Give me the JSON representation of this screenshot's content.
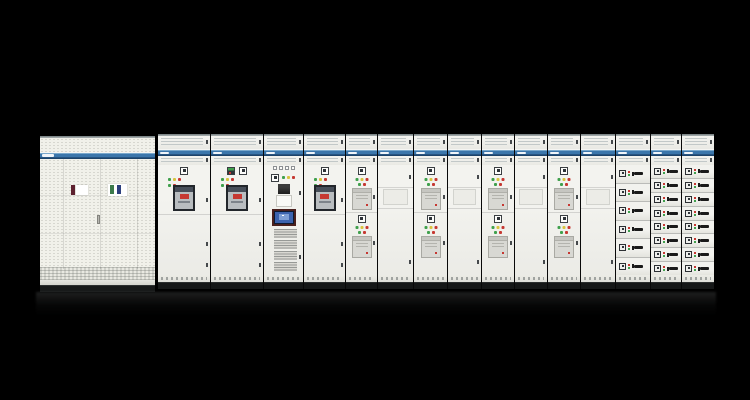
{
  "colors": {
    "background": "#000000",
    "cabinet_body": "#f1f1ea",
    "brand_band_blue": "#3b76ab",
    "brand_band_navy": "#173a5e",
    "indicator_green": "#3fa04c",
    "indicator_yellow": "#d8c33e",
    "indicator_red": "#c63832",
    "acb_red": "#bf3a33",
    "module_gray": "#d8d8d3",
    "hmi_frame": "#4a201d",
    "hmi_screen": "#3c63ae",
    "drawer_handle": "#1a1a1a",
    "plinth": "#161818",
    "label_maroon": "#5e2230",
    "label_white": "#ffffff",
    "label_green": "#3c7a4b",
    "label_navy": "#2c3f7d"
  },
  "left_cabinet": {
    "door_panels": 4,
    "labels": [
      {
        "name": "maroon-label",
        "color": "#5e2230"
      },
      {
        "name": "white-label",
        "color": "#ffffff"
      },
      {
        "name": "green-label",
        "color": "#3c7a4b"
      },
      {
        "name": "navy-label",
        "color": "#2c3f7d"
      }
    ]
  },
  "lineup": {
    "indicator_rows": [
      [
        "green",
        "yellow",
        "red"
      ],
      [
        "green",
        "red"
      ]
    ],
    "drawer_dots": [
      "red",
      "green"
    ],
    "cabinets": [
      {
        "id": "incomer-1",
        "type": "acb",
        "width": 52,
        "meter": false
      },
      {
        "id": "incomer-2",
        "type": "acb",
        "width": 53,
        "meter": true
      },
      {
        "id": "control-hmi",
        "type": "control",
        "width": 40,
        "mini_squares": 4,
        "module_groups": 4
      },
      {
        "id": "incomer-3",
        "type": "acb",
        "width": 42,
        "meter": false
      },
      {
        "id": "feeder-1",
        "type": "module2",
        "width": 32
      },
      {
        "id": "vent-door-1",
        "type": "mesh",
        "width": 36
      },
      {
        "id": "feeder-2",
        "type": "module2",
        "width": 34
      },
      {
        "id": "vent-door-2",
        "type": "mesh",
        "width": 34
      },
      {
        "id": "feeder-3",
        "type": "module2",
        "width": 33
      },
      {
        "id": "vent-door-3",
        "type": "mesh",
        "width": 33
      },
      {
        "id": "feeder-4",
        "type": "module2",
        "width": 33
      },
      {
        "id": "vent-door-4",
        "type": "mesh",
        "width": 35
      },
      {
        "id": "mcc-drawers-1",
        "type": "drawers",
        "width": 35,
        "drawer_count": 6
      },
      {
        "id": "mcc-drawers-2",
        "type": "drawers",
        "width": 31,
        "drawer_count": 8
      },
      {
        "id": "mcc-drawers-3",
        "type": "drawers",
        "width": 33,
        "drawer_count": 8
      }
    ]
  }
}
